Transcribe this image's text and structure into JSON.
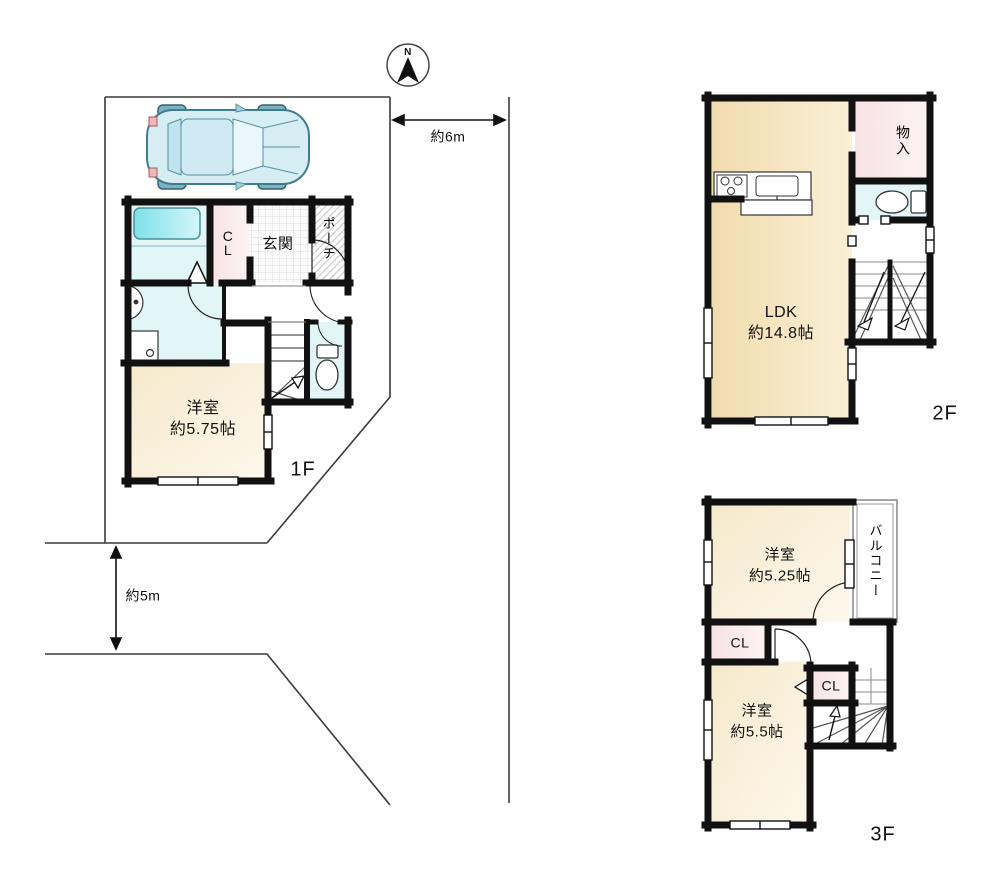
{
  "site": {
    "north_label": "N",
    "width_dimension": "約6m",
    "depth_dimension": "約5m"
  },
  "floor1": {
    "label": "1F",
    "closet": "CL",
    "entrance": "玄関",
    "porch": "ポーチ",
    "room": "洋室",
    "room_size": "約5.75帖"
  },
  "floor2": {
    "label": "2F",
    "ldk": "LDK",
    "ldk_size": "約14.8帖",
    "storage": "物入"
  },
  "floor3": {
    "label": "3F",
    "room1": "洋室",
    "room1_size": "約5.25帖",
    "balcony": "バルコニー",
    "closet1": "CL",
    "closet2": "CL",
    "room2": "洋室",
    "room2_size": "約5.5帖"
  },
  "colors": {
    "wall": "#111111",
    "site_line": "#3a3a3a",
    "room_cream": "#f8efd9",
    "ldk_beige": "#f2ddb0",
    "closet_pink": "#fbecec",
    "wet_area_cyan": "#e3f6f7",
    "bathtub_cyan": "#8ae4ee",
    "car_blue": "#d6edf3"
  }
}
